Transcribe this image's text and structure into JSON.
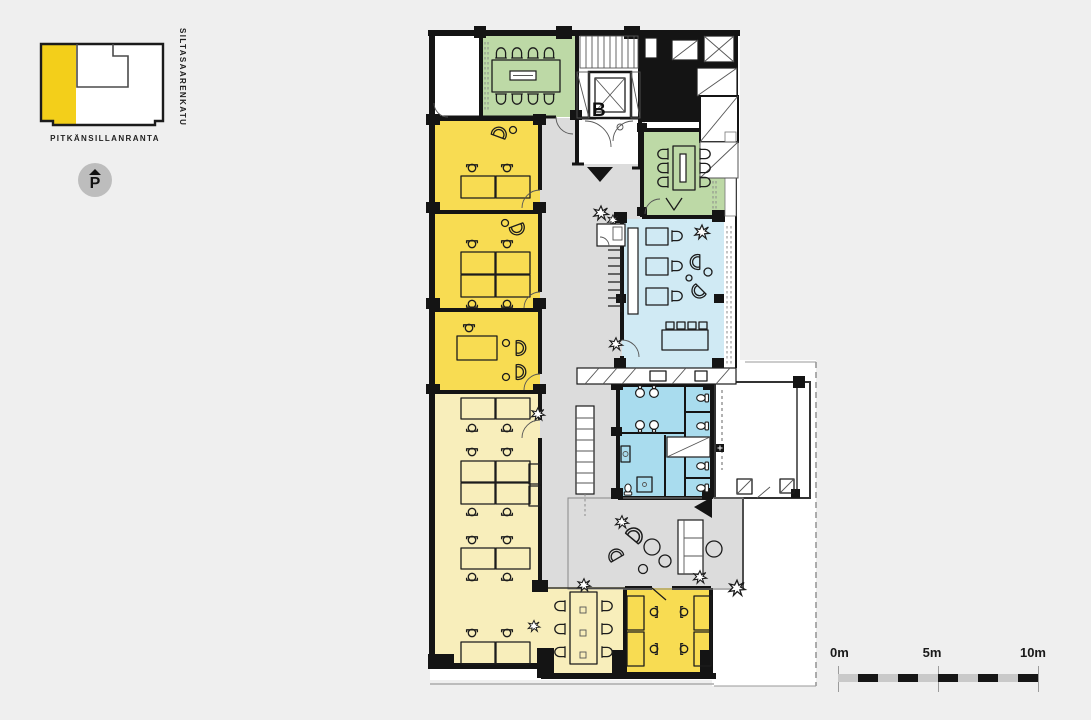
{
  "colors": {
    "background": "#efefef",
    "corridor_gray": "#dcdcdc",
    "wall_black": "#141414",
    "office_yellow": "#f8dc52",
    "open_office_yellow": "#f8eebb",
    "meeting_green": "#bdd9a6",
    "cafe_blue": "#d0eaf4",
    "wc_blue": "#a9dcee",
    "map_highlight_yellow": "#f3cf1a",
    "badge_gray": "#bdbdbd"
  },
  "key_map": {
    "street_bottom_label": "PITKÄNSILLANRANTA",
    "street_right_label": "SILTASAARENKATU",
    "parking_symbol": "P"
  },
  "floor_plan": {
    "stairwell_label": "B"
  },
  "scale_bar": {
    "labels": [
      "0m",
      "5m",
      "10m"
    ]
  }
}
